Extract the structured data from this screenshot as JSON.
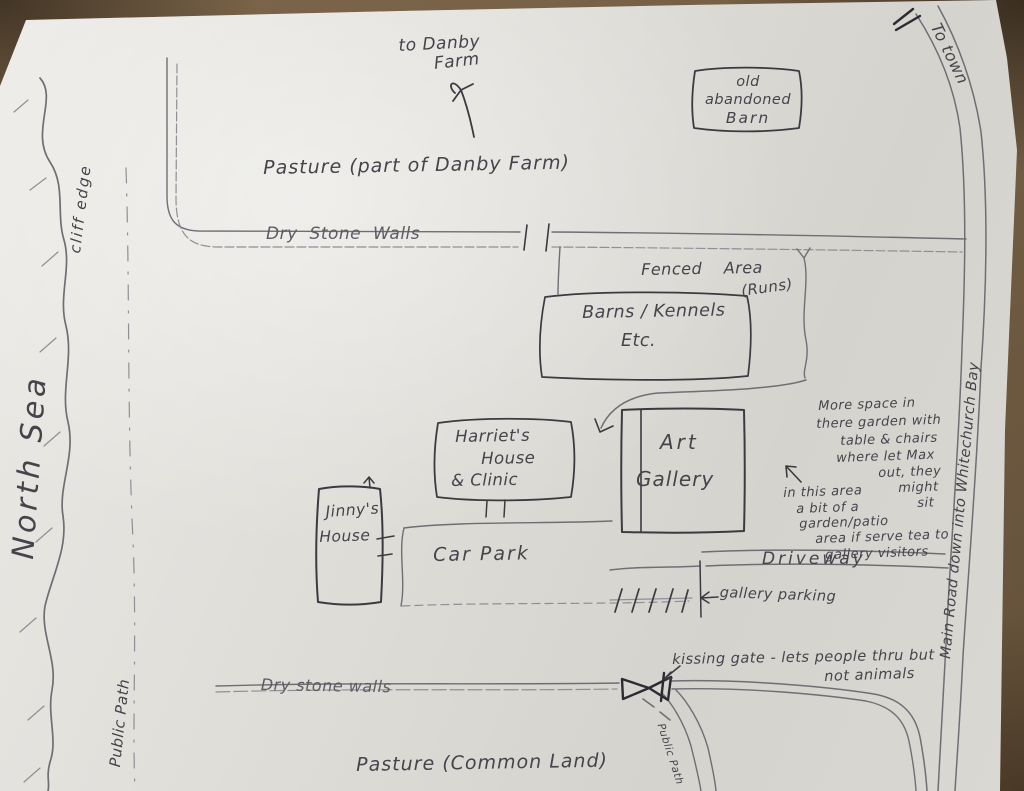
{
  "title": "Hand-drawn map of Whitechurch Bay area",
  "colors": {
    "background": "#6e5a41",
    "paper": "#dedcd7",
    "pencil": "#6f6e74",
    "ink": "#3b3a41",
    "ink_heavy": "#2c2b31",
    "text": "#45444b"
  },
  "map": {
    "sea_label": "North Sea",
    "cliff_label": "cliff edge",
    "public_path_left": "Public Path",
    "to_danby": [
      "to Danby",
      "Farm"
    ],
    "pasture_top": "Pasture (part of Danby Farm)",
    "old_barn": [
      "old",
      "abandoned",
      "Barn"
    ],
    "to_town": "To town",
    "dry_stone_walls_top": "Dry Stone Walls",
    "fenced_area": [
      "Fenced Area",
      "(Runs)"
    ],
    "barns": [
      "Barns / Kennels",
      "Etc."
    ],
    "harriets_house": [
      "Harriet's",
      "House",
      "& Clinic"
    ],
    "art_gallery": [
      "Art",
      "Gallery"
    ],
    "garden_note": [
      "More space in",
      "there garden with",
      "table & chairs",
      "where let Max",
      "out, they",
      "might",
      "sit"
    ],
    "patio_note": [
      "in this area",
      "a bit of a",
      "garden/patio",
      "area if serve tea to",
      "gallery visitors"
    ],
    "jinnys_house": [
      "Jinny's",
      "House"
    ],
    "car_park": "Car Park",
    "driveway": "Driveway",
    "gallery_parking": "gallery parking",
    "kissing_gate_note": [
      "kissing gate - lets people thru but",
      "not animals"
    ],
    "dry_stone_walls_bottom": "Dry stone walls",
    "public_path_bottom": "Public Path",
    "pasture_bottom": "Pasture (Common Land)",
    "main_road": "Main Road down into Whitechurch Bay"
  }
}
